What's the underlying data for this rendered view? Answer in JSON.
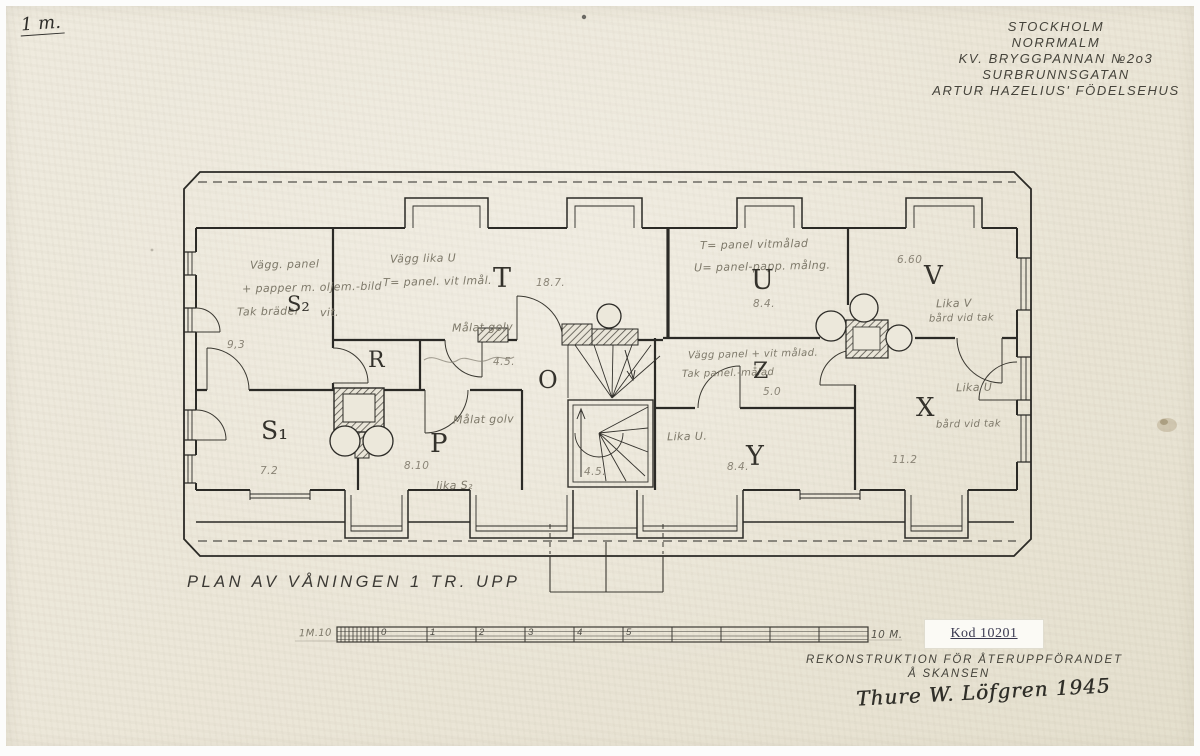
{
  "page": {
    "scale_note": "1 m.",
    "title_block": [
      "STOCKHOLM",
      "NORRMALM",
      "KV. BRYGGPANNAN №2o3",
      "SURBRUNNSGATAN",
      "ARTUR HAZELIUS' FÖDELSEHUS"
    ]
  },
  "plan": {
    "rooms": {
      "s2": {
        "label": "S₂",
        "area": "9,3",
        "note1": "Vägg. panel",
        "note2": "+ papper m. oljem.-bild",
        "note3a": "Tak bräder",
        "note3b": "vit."
      },
      "t": {
        "label": "T",
        "area": "18.7.",
        "note1": "Vägg lika U",
        "note2": "T= panel. vit lmål.",
        "note3": "Målat golv"
      },
      "u": {
        "label": "U",
        "area": "8.4.",
        "note1": "T= panel vitmålad",
        "note2": "U= panel-papp. målng."
      },
      "v": {
        "label": "V",
        "area": "6.60",
        "note1": "Lika V",
        "note2": "bård vid tak"
      },
      "z": {
        "label": "Z",
        "area": "5.0",
        "note1": "Vägg panel + vit målad.",
        "note2": "Tak panel.-målad"
      },
      "y": {
        "label": "Y",
        "area": "8.4.",
        "note1": "Lika U."
      },
      "x": {
        "label": "X",
        "area": "11.2",
        "note1": "Lika U",
        "note2": "bård vid tak"
      },
      "s1": {
        "label": "S₁",
        "area": "7.2"
      },
      "r": {
        "label": "R"
      },
      "p": {
        "label": "P",
        "area": "8.10",
        "note1": "Målat golv",
        "note2": "lika S₂"
      },
      "o": {
        "label": "O",
        "area1": "4.5.",
        "area2": "4.5."
      }
    }
  },
  "footer": {
    "plan_title": "PLAN AV VÅNINGEN 1 TR. UPP",
    "scale": {
      "prefix": "1M.10",
      "ticks": [
        "0",
        "1",
        "2",
        "3",
        "4",
        "5"
      ],
      "end": "10 M."
    },
    "kod_label": "Kod 10201",
    "recon_line1": "REKONSTRUKTION FÖR ÅTERUPPFÖRANDET",
    "recon_line2": "Å SKANSEN",
    "signature": "Thure W. Löfgren 1945"
  }
}
